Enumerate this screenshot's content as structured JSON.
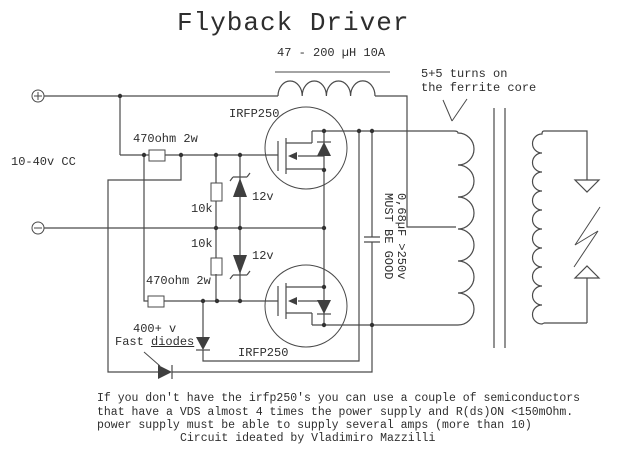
{
  "title": "Flyback Driver",
  "colors": {
    "line": "#4a4a4a",
    "text": "#2e2e2e",
    "background": "#ffffff"
  },
  "schematic": {
    "inductor_label": "47 - 200 µH 10A",
    "turns_note": [
      "5+5 turns on",
      "the ferrite core"
    ],
    "supply_label": "10-40v CC",
    "plus_terminal": "+",
    "minus_terminal": "-",
    "mosfet_top_label": "IRFP250",
    "mosfet_bottom_label": "IRFP250",
    "resistor_top_label": "470ohm 2w",
    "resistor_bottom_label": "470ohm 2w",
    "r10k_top_label": "10k",
    "r10k_bottom_label": "10k",
    "zener_top_label": "12v",
    "zener_bottom_label": "12v",
    "hv_label": "400+ v",
    "fast_diodes_prefix": "Fast ",
    "fast_diodes_word": "diodes",
    "capacitor_note_line1": "0,68µF >250v",
    "capacitor_note_line2": "MUST BE GOOD"
  },
  "footer": {
    "line1": "If you don't have the irfp250's you can use a couple of semiconductors",
    "line2": "that have a VDS almost 4 times the power supply and R(ds)ON <150mOhm.",
    "line3": "power supply must be able to supply several amps (more than 10)",
    "line4": "Circuit ideated by Vladimiro Mazzilli"
  }
}
